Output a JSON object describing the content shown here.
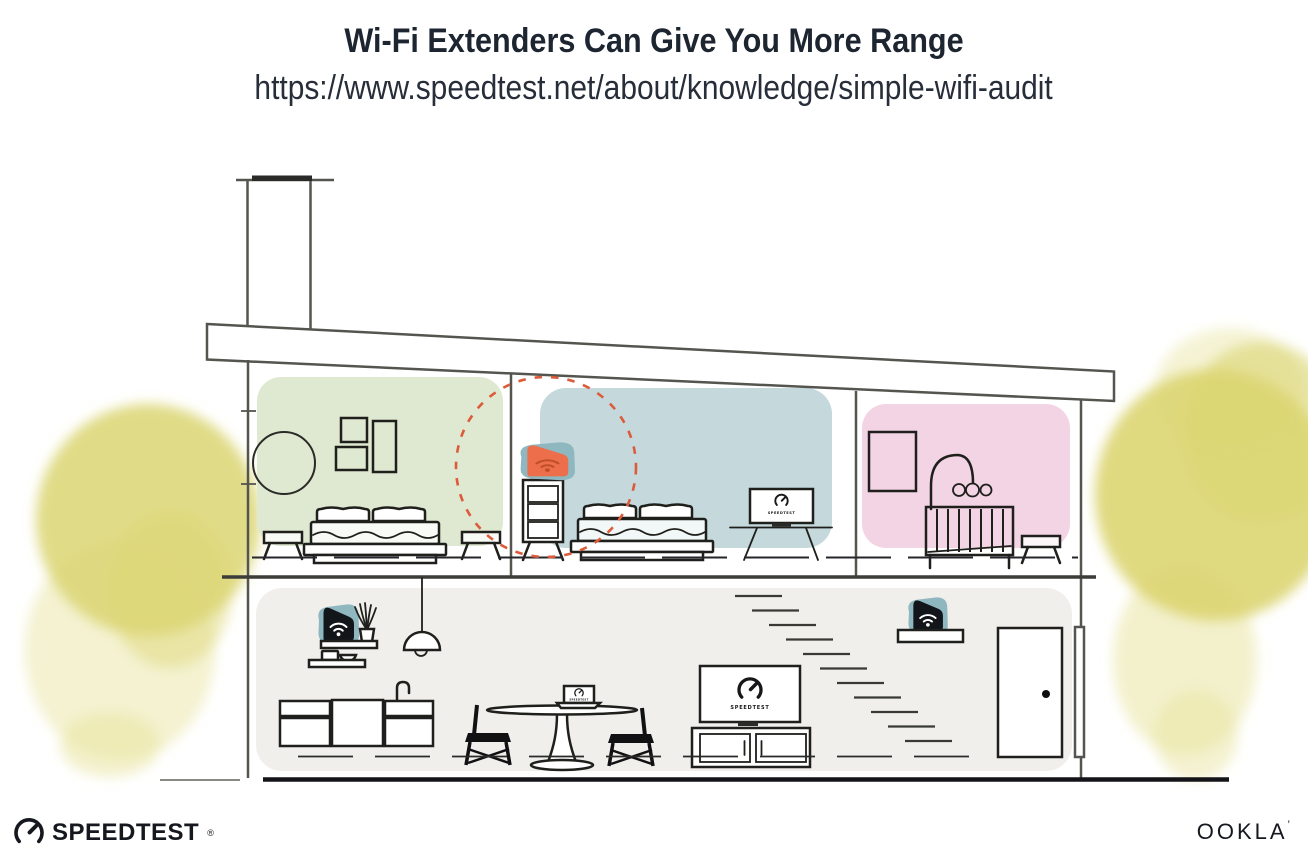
{
  "header": {
    "title": "Wi-Fi Extenders Can Give You More Range",
    "url": "https://www.speedtest.net/about/knowledge/simple-wifi-audit"
  },
  "devices": {
    "tv_bedroom_label": "SPEEDTEST",
    "tv_living_label": "SPEEDTEST",
    "laptop_label": "SPEEDTEST"
  },
  "branding": {
    "speedtest": "SPEEDTEST",
    "speedtest_reg": "®",
    "ookla": "OOKLA",
    "ookla_tm": "’"
  },
  "colors": {
    "title_text": "#1d2531",
    "structure_outline": "#55554f",
    "furniture_outline": "#1f1f1c",
    "room_green": "#dfe8d0",
    "room_blue": "#c5d8dc",
    "room_pink": "#f3d4e5",
    "room_gray": "#f1efec",
    "tree_yellow": "#dbd572",
    "tree_yellow_light": "#e9e5a2",
    "extender_teal": "#8fb7bf",
    "extender_dark": "#12161a",
    "extender_orange": "#ec6e4b",
    "extender_orange_dark": "#bf4f27",
    "coverage_ring": "#dc5b3b"
  }
}
